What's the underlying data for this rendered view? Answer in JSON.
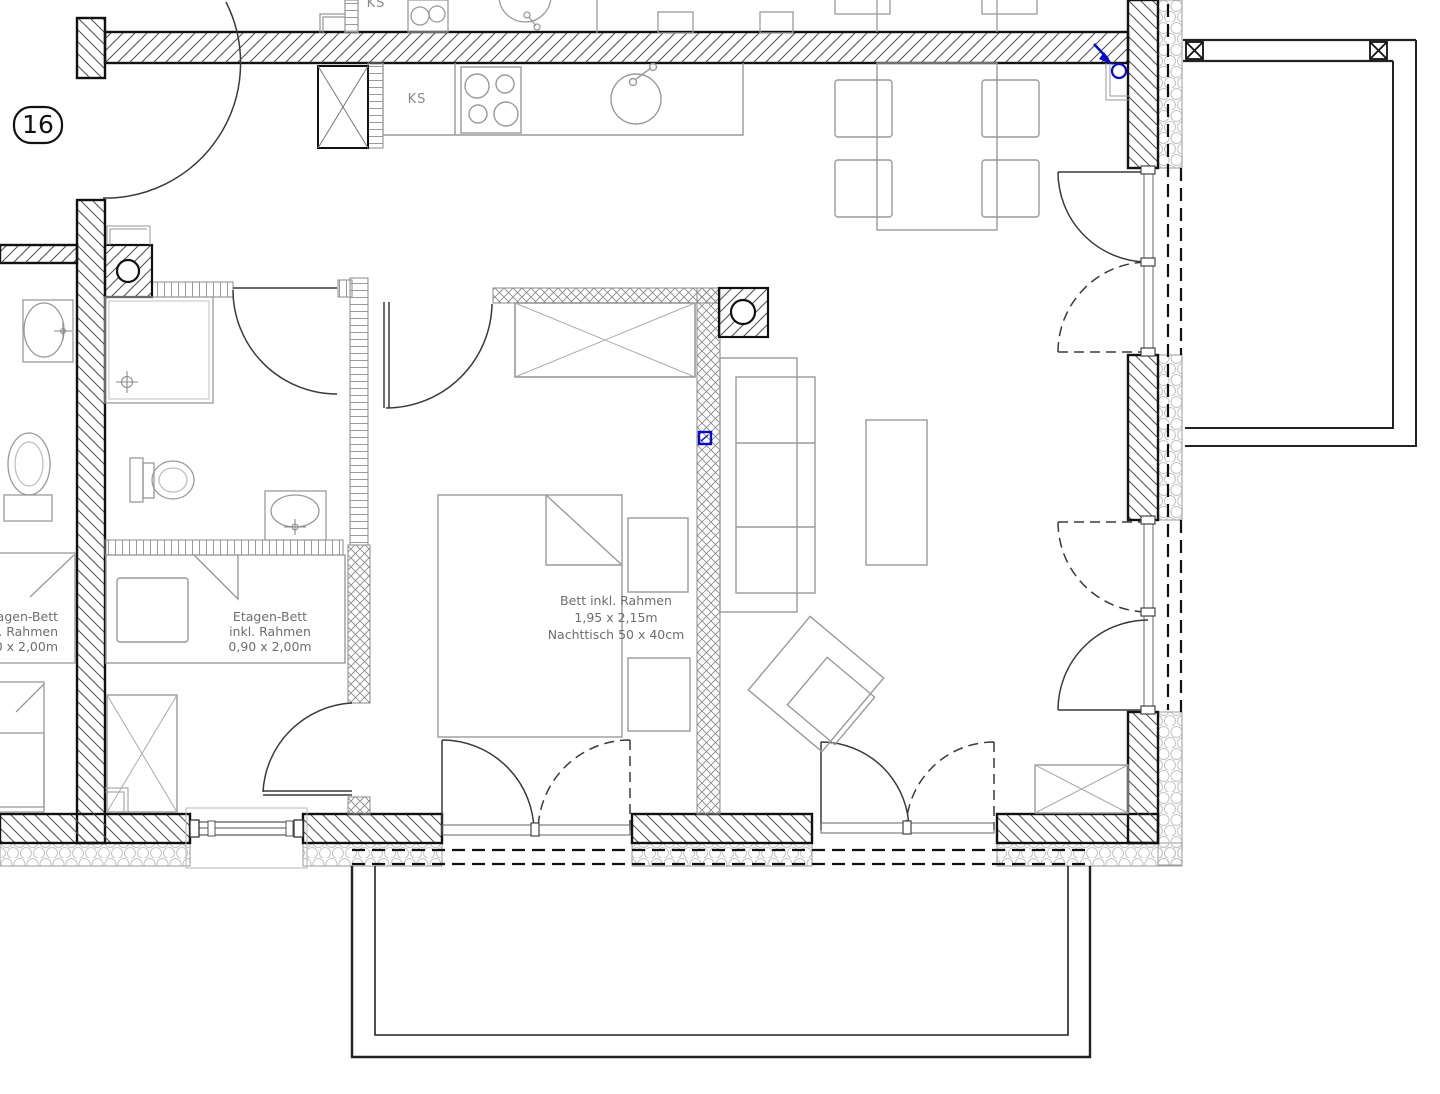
{
  "plan": {
    "unit_badge": "16",
    "kitchen": {
      "ks_label": "KS",
      "ks_label_upper": "KS"
    },
    "labels": {
      "bedroom": {
        "line1": "Bett inkl. Rahmen",
        "line2": "1,95 x 2,15m",
        "line3": "Nachttisch 50 x 40cm"
      },
      "kids_room": {
        "line1": "Etagen-Bett",
        "line2": "inkl. Rahmen",
        "line3": "0,90 x 2,00m"
      },
      "neighbor_room": {
        "line1": "Etagen-Bett",
        "line2": "inkl. Rahmen",
        "line3": "0,90 x 2,00m"
      }
    },
    "colors": {
      "wall_line": "#111111",
      "furniture": "#9a9a9a",
      "text": "#6e6e6e",
      "electric": "#0a0acc"
    }
  }
}
